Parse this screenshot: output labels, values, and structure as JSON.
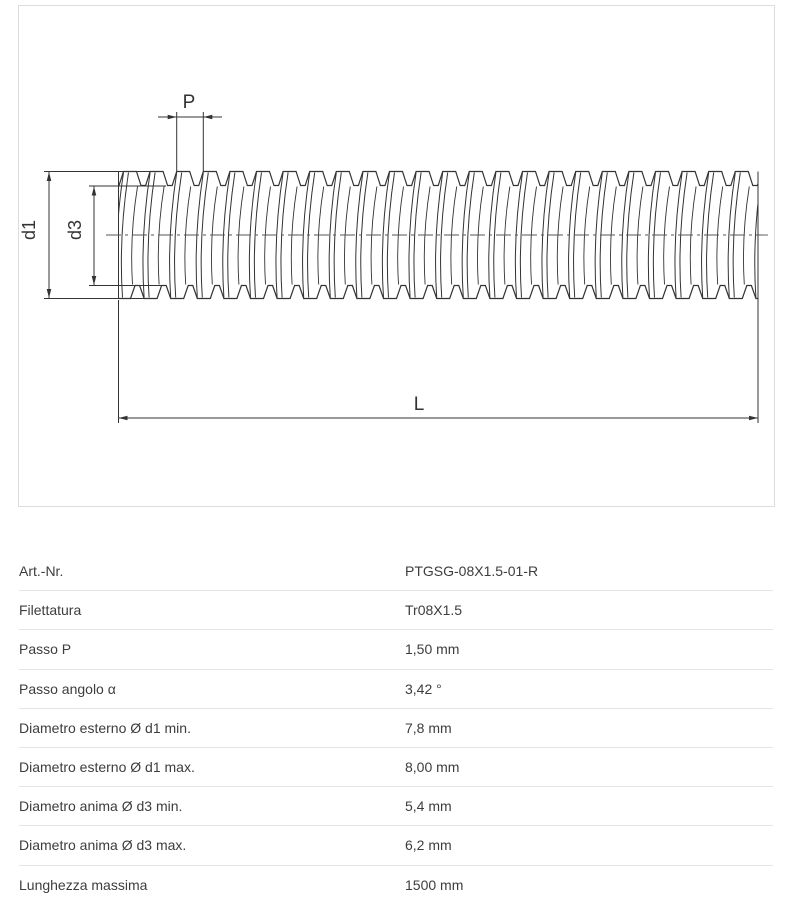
{
  "drawing": {
    "labels": {
      "pitch": "P",
      "outer_diameter": "d1",
      "core_diameter": "d3",
      "length": "L"
    }
  },
  "spec_table": {
    "rows": [
      {
        "label": "Art.-Nr.",
        "value": "PTGSG-08X1.5-01-R"
      },
      {
        "label": "Filettatura",
        "value": "Tr08X1.5"
      },
      {
        "label": "Passo P",
        "value": "1,50 mm"
      },
      {
        "label": "Passo angolo α",
        "value": "3,42 °"
      },
      {
        "label": "Diametro esterno Ø d1 min.",
        "value": "7,8 mm"
      },
      {
        "label": "Diametro esterno Ø d1 max.",
        "value": "8,00 mm"
      },
      {
        "label": "Diametro anima Ø d3 min.",
        "value": "5,4 mm"
      },
      {
        "label": "Diametro anima Ø d3 max.",
        "value": "6,2 mm"
      },
      {
        "label": "Lunghezza massima",
        "value": "1500 mm"
      }
    ]
  },
  "colors": {
    "drawing_line": "#333333",
    "panel_border": "#dcdcdc",
    "table_separator": "#e4e4e4",
    "table_text": "#3d3d3d",
    "background": "#ffffff"
  }
}
